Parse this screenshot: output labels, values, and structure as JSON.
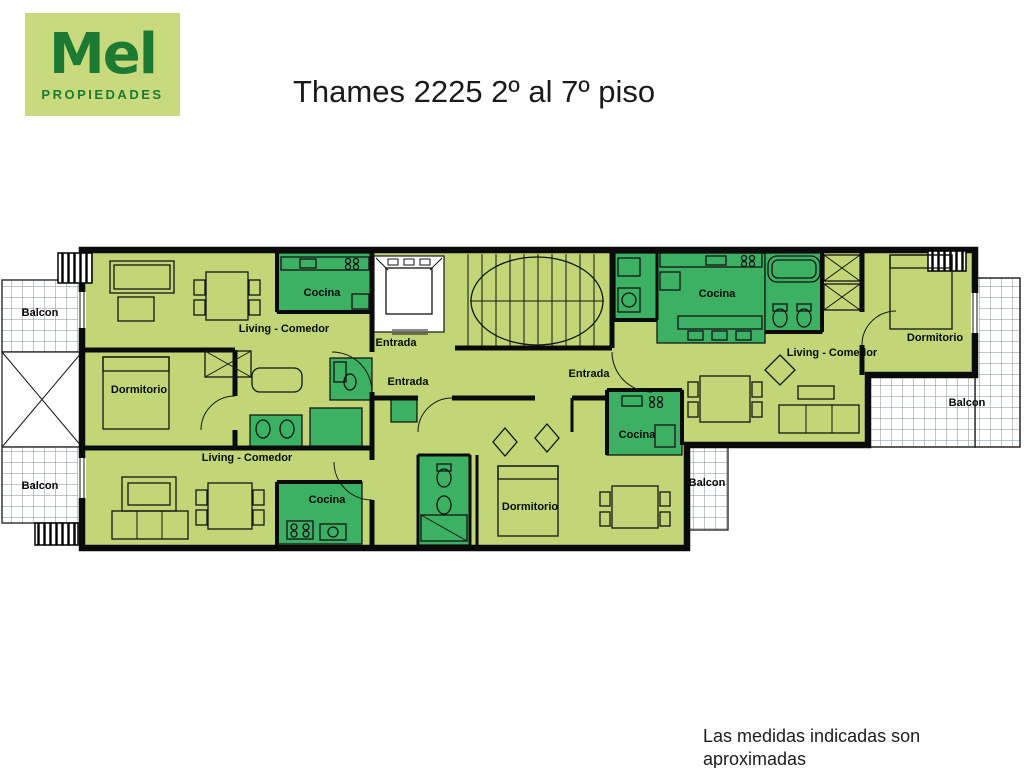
{
  "logo": {
    "title": "Mel",
    "subtitle": "PROPIEDADES"
  },
  "header": {
    "title": "Thames 2225 2º al 7º piso"
  },
  "plan": {
    "labels": {
      "balcon": "Balcon",
      "cocina": "Cocina",
      "dormitorio": "Dormitorio",
      "entrada": "Entrada",
      "living_comedor": "Living - Comedor"
    }
  },
  "footer": {
    "line1": "Las medidas indicadas son aproximadas",
    "line2": "y a solo efecto orientativo"
  },
  "colors": {
    "floor": "#c2d678",
    "wet": "#3cb063",
    "wall": "#0a0a0a",
    "grid": "#7e8f9c",
    "logo-bg": "#c8da7d",
    "logo-fg": "#1d7a33"
  }
}
